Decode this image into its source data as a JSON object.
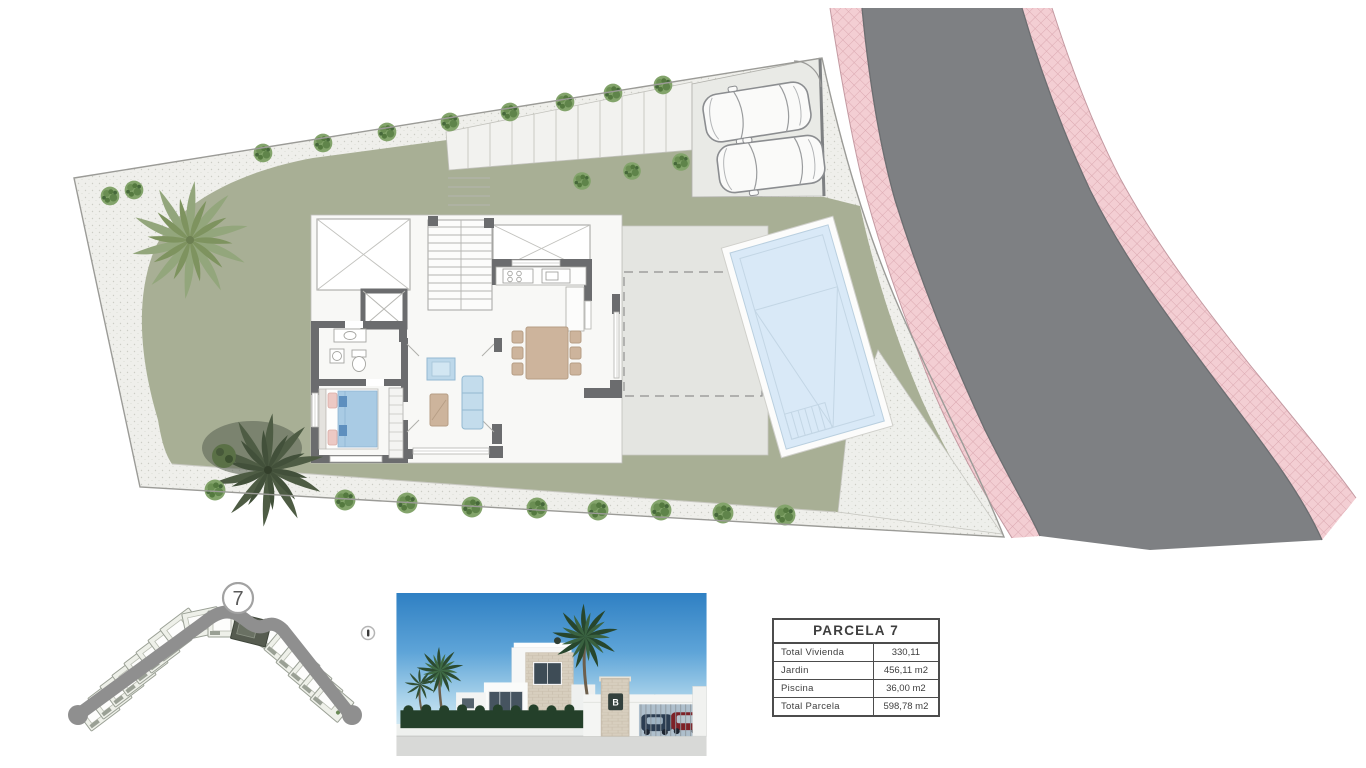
{
  "parcel": {
    "number": "7",
    "table": {
      "title": "PARCELA 7",
      "rows": [
        {
          "label": "Total Vivienda",
          "value": "330,11"
        },
        {
          "label": "Jardin",
          "value": "456,11 m2"
        },
        {
          "label": "Piscina",
          "value": "36,00 m2"
        },
        {
          "label": "Total Parcela",
          "value": "598,78 m2"
        }
      ]
    }
  },
  "render": {
    "logo_letter": "B"
  },
  "colors": {
    "garden_green": "#a8af95",
    "pavement": "#efefeb",
    "terrace_gray": "#e4e5e1",
    "parking_gray": "#e9eae6",
    "road_gray": "#7e8083",
    "sidewalk_pink": "#f3ced3",
    "pool_blue": "#d9e9f7",
    "wall_gray": "#6b6c6e"
  },
  "icons": {
    "info_marker": "i-circle",
    "parcel_marker": "circle-7",
    "car": "car-top-view",
    "palm": "palm-tree",
    "bush": "round-bush"
  }
}
